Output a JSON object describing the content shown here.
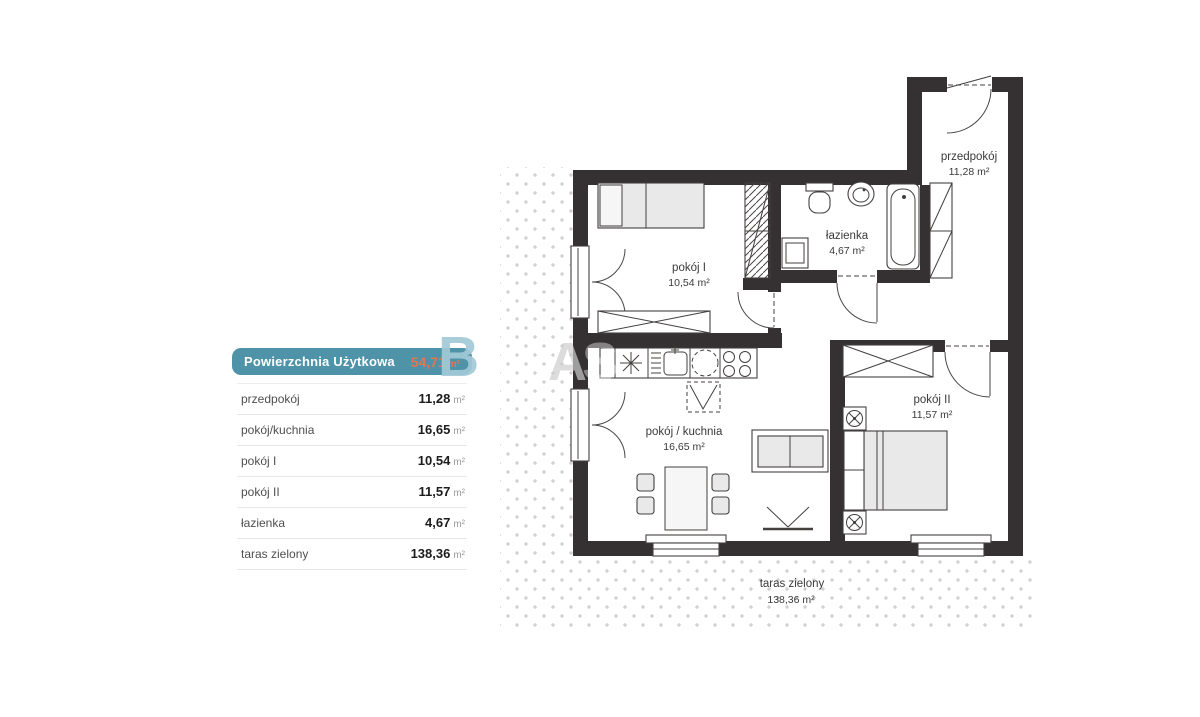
{
  "panel": {
    "header": {
      "label": "Powierzchnia Użytkowa",
      "value": "54,71",
      "unit": "m²"
    },
    "rows": [
      {
        "label": "przedpokój",
        "value": "11,28",
        "unit": "m²"
      },
      {
        "label": "pokój/kuchnia",
        "value": "16,65",
        "unit": "m²"
      },
      {
        "label": "pokój I",
        "value": "10,54",
        "unit": "m²"
      },
      {
        "label": "pokój II",
        "value": "11,57",
        "unit": "m²"
      },
      {
        "label": "łazienka",
        "value": "4,67",
        "unit": "m²"
      },
      {
        "label": "taras zielony",
        "value": "138,36",
        "unit": "m²"
      }
    ]
  },
  "plan": {
    "rooms": {
      "przedpokoj": {
        "name": "przedpokój",
        "area": "11,28 m²"
      },
      "lazienka": {
        "name": "łazienka",
        "area": "4,67 m²"
      },
      "pokoj1": {
        "name": "pokój I",
        "area": "10,54 m²"
      },
      "pokoj_kuchnia": {
        "name": "pokój / kuchnia",
        "area": "16,65 m²"
      },
      "pokoj2": {
        "name": "pokój II",
        "area": "11,57 m²"
      },
      "taras": {
        "name": "taras zielony",
        "area": "138,36 m²"
      }
    }
  },
  "watermark": {
    "letters": [
      "B",
      "A",
      "S"
    ]
  },
  "colors": {
    "accent_teal": "#4e93a8",
    "accent_orange": "#e4764d",
    "wall": "#353031",
    "dots": "#c3c3c3"
  }
}
